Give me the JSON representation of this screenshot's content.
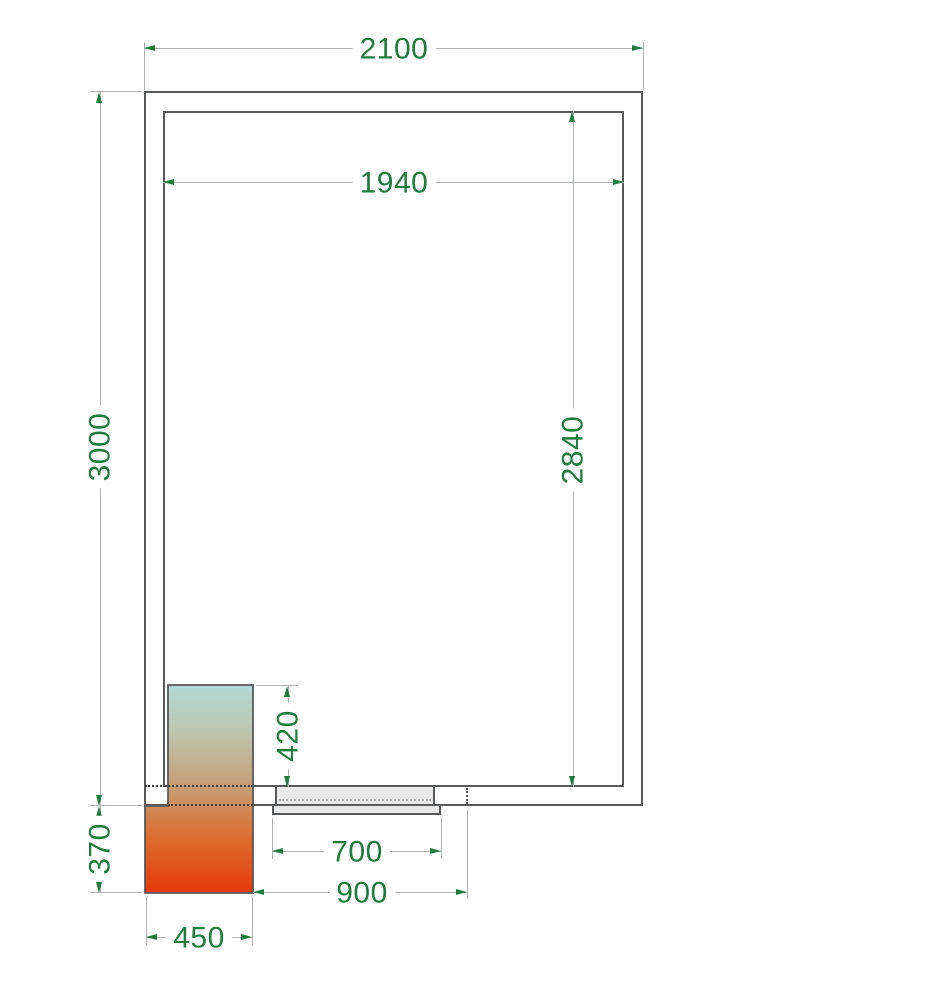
{
  "drawing": {
    "colors": {
      "dimension_text_green": "#1e7c3c",
      "dimension_line_gray": "#b0b3b5",
      "wall_line_gray": "#58595b",
      "hidden_line_dark": "#3c3c3c",
      "door_fill_gray": "#e9e9e9",
      "cooler_gradient_top": "#b2dad7",
      "cooler_gradient_middle": "#c79b71",
      "cooler_gradient_bottom": "#e6390b"
    },
    "dimensions": {
      "outer_width": "2100",
      "inner_width": "1940",
      "outer_height": "3000",
      "inner_height": "2840",
      "cooling_unit_inside_depth": "420",
      "cooling_unit_outside_depth": "370",
      "door_leaf_width": "700",
      "door_overall_width": "900",
      "cooling_unit_width": "450"
    }
  }
}
